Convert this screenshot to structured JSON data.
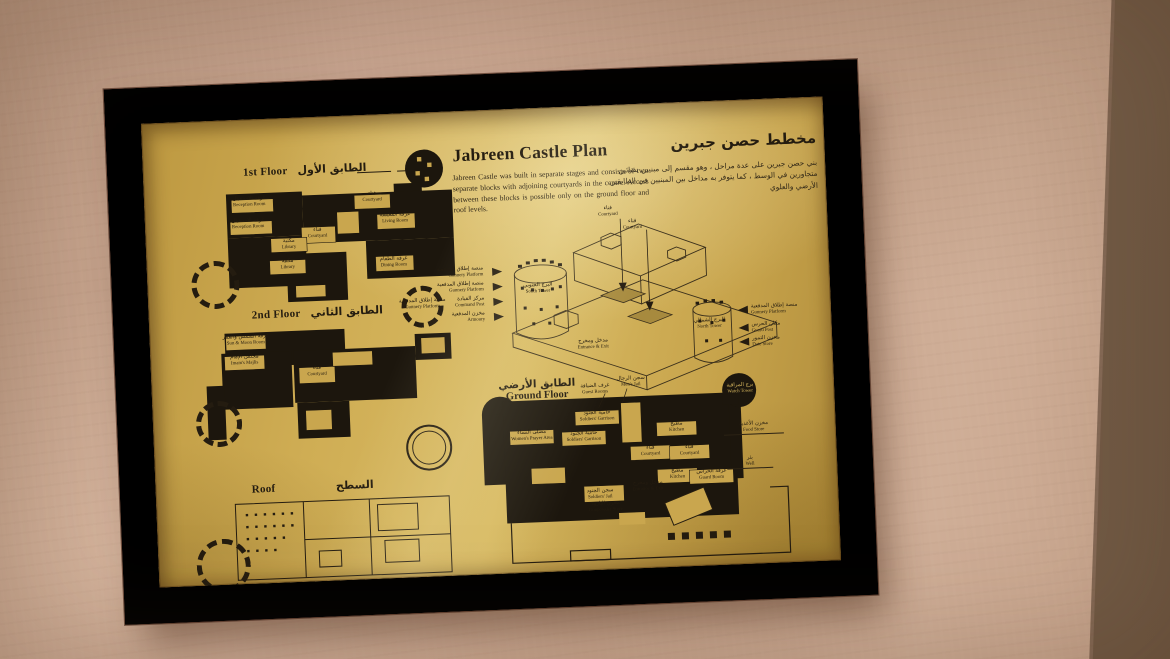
{
  "photo": {
    "scene": "Framed brass plaque with castle floor plans on a plaster wall",
    "colors": {
      "wall": "#c8a68f",
      "wall_dark": "#7c644e",
      "frame_wood": "#6a4232",
      "plaque_gold": "#cba94f",
      "ink": "#241c10"
    }
  },
  "plaque": {
    "title_en": "Jabreen Castle Plan",
    "intro_en": "Jabreen Castle was built in separate stages and consists of two separate blocks with adjoining courtyards in the centre. Access between these blocks is possible only on the ground floor and roof levels.",
    "title_ar": "مخطط حصن جبرين",
    "intro_ar": "بني حصن جبرين على عدة مراحل ، وهو مقسم إلى مبنيين بفنائين متجاورين في الوسط ، كما يتوفر به مداخل بين المبنيين في الطابقين الأرضي والعلوي",
    "floors": {
      "first": {
        "en": "1st Floor",
        "ar": "الطابق الأول",
        "rooms": [
          {
            "ar": "غرفة الاستقبال",
            "en": "Reception Room"
          },
          {
            "ar": "غرفة الاستقبال",
            "en": "Reception Room"
          },
          {
            "ar": "فناء",
            "en": "Courtyard"
          },
          {
            "ar": "فناء",
            "en": "Courtyard"
          },
          {
            "ar": "مكتبة",
            "en": "Library"
          },
          {
            "ar": "مكتبة",
            "en": "Library"
          },
          {
            "ar": "غرفة الطعام",
            "en": "Dining Room"
          },
          {
            "ar": "غرفة المعيشة",
            "en": "Living Room"
          }
        ]
      },
      "second": {
        "en": "2nd Floor",
        "ar": "الطابق الثاني",
        "rooms": [
          {
            "ar": "غرفة الشمس والقمر",
            "en": "Sun & Moon Room"
          },
          {
            "ar": "مجلس الإمام",
            "en": "Imam's Majlis"
          },
          {
            "ar": "فناء",
            "en": "Courtyard"
          },
          {
            "ar": "منصة إطلاق المدفعية",
            "en": "Gunnery Platform"
          }
        ]
      },
      "roof": {
        "en": "Roof",
        "ar": "السطح"
      },
      "ground": {
        "en": "Ground Floor",
        "ar": "الطابق الأرضي",
        "rooms": [
          {
            "ar": "حامية الجنود",
            "en": "Soldiers' Garrison"
          },
          {
            "ar": "حامية الجنود",
            "en": "Soldiers' Garrison"
          },
          {
            "ar": "مصلى النساء",
            "en": "Women's Prayer Area"
          },
          {
            "ar": "سجن الرجال",
            "en": "Men's Jail"
          },
          {
            "ar": "غرف الضيافة",
            "en": "Guest Rooms"
          },
          {
            "ar": "مطبخ",
            "en": "Kitchen"
          },
          {
            "ar": "مطبخ",
            "en": "Kitchen"
          },
          {
            "ar": "فناء",
            "en": "Courtyard"
          },
          {
            "ar": "فناء",
            "en": "Courtyard"
          },
          {
            "ar": "غرفة الحراس",
            "en": "Guard Room"
          },
          {
            "ar": "مخزن الأغذية",
            "en": "Food Store"
          },
          {
            "ar": "بئر",
            "en": "Well"
          },
          {
            "ar": "مدخل ومخرج",
            "en": "Entrance & Exit"
          },
          {
            "ar": "سجن الجنود",
            "en": "Soldiers' Jail"
          },
          {
            "ar": "مخزن البارود",
            "en": "Gunpowder Store"
          },
          {
            "ar": "برج المراقبة",
            "en": "Watch Tower"
          }
        ]
      }
    },
    "isometric": {
      "south_tower": {
        "ar": "البرج الجنوبي",
        "en": "South Tower"
      },
      "north_tower": {
        "ar": "البرج الشمالي",
        "en": "North Tower"
      },
      "left_callouts": [
        {
          "ar": "منصة إطلاق المدفعية",
          "en": "Gunnery Platform"
        },
        {
          "ar": "منصة إطلاق المدفعية",
          "en": "Gunnery Platform"
        },
        {
          "ar": "مركز القيادة",
          "en": "Command Post"
        },
        {
          "ar": "مخزن المدفعية",
          "en": "Armoury"
        }
      ],
      "right_callouts": [
        {
          "ar": "منصة إطلاق المدفعية",
          "en": "Gunnery Platform"
        },
        {
          "ar": "مكان الحرس",
          "en": "Guard Post"
        },
        {
          "ar": "مخزن التمور",
          "en": "Date Store"
        }
      ],
      "courtyard_callouts": [
        {
          "ar": "فناء",
          "en": "Courtyard"
        },
        {
          "ar": "فناء",
          "en": "Courtyard"
        }
      ],
      "entrance": {
        "ar": "مدخل ومخرج",
        "en": "Entrance & Exit"
      }
    }
  }
}
